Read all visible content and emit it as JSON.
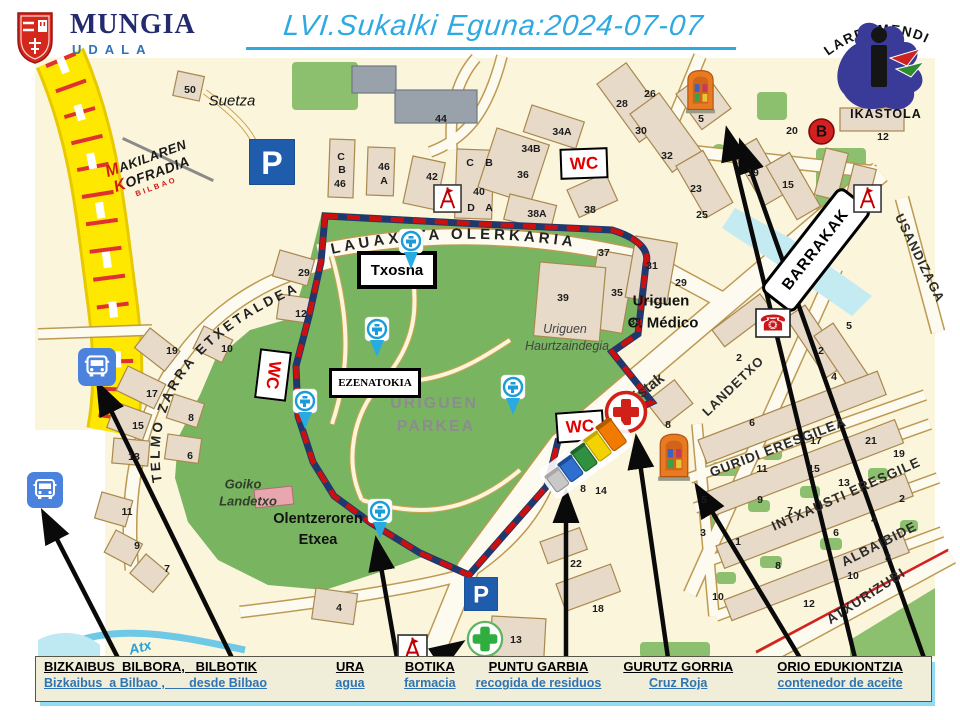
{
  "header": {
    "municipality": {
      "name": "MUNGIA",
      "subtitle": "UDALA"
    },
    "title": "LVI.Sukalki Eguna:2024-07-07",
    "school": {
      "top": "LARRAMENDI",
      "bottom": "IKASTOLA"
    },
    "brotherhood": {
      "line1": "MAKILAREN",
      "line2": "KOFRADIA",
      "line3": "BILBAO"
    }
  },
  "map": {
    "glyphs": {
      "parking": "P",
      "bus_line": "B",
      "phone": "☎",
      "wc": "WC"
    },
    "colors": {
      "title_blue": "#2FA9E2",
      "park_green": "#79B561",
      "dash_red": "#CC1010",
      "dash_navy": "#20386B",
      "legend_bg": "#F0EDD8",
      "accent_blue": "#2E74B5"
    },
    "arc_streets": [
      {
        "t": "LAUAXETA OLERKARIA"
      },
      {
        "t": "TELMO ZARRA ETXETALDEA"
      }
    ],
    "streets": [
      {
        "t": "Pistak",
        "x": 645,
        "y": 390,
        "r": -38,
        "s": 15,
        "b": 1
      },
      {
        "t": "LANDETXO",
        "x": 733,
        "y": 386,
        "r": -44,
        "s": 13,
        "ls": 1
      },
      {
        "t": "GURIDI ERESGILEA",
        "x": 778,
        "y": 447,
        "r": -21,
        "s": 13.5,
        "ls": 1
      },
      {
        "t": "INTXAUSTI ERESGILE",
        "x": 846,
        "y": 494,
        "r": -24,
        "s": 13.5,
        "ls": 1
      },
      {
        "t": "ALBAIBIDE",
        "x": 879,
        "y": 544,
        "r": -27,
        "s": 13.5,
        "ls": 1
      },
      {
        "t": "ATXURIZUBI",
        "x": 866,
        "y": 596,
        "r": -33,
        "s": 13.5,
        "ls": 1
      },
      {
        "t": "USANDIZAGA",
        "x": 920,
        "y": 258,
        "r": 64,
        "s": 13,
        "ls": 1
      }
    ],
    "places": [
      {
        "t": "Suetza",
        "x": 232,
        "y": 101,
        "s": 15,
        "i": 1,
        "c": "#111"
      },
      {
        "t": "Uriguen",
        "x": 661,
        "y": 301,
        "s": 15,
        "b": 1,
        "c": "#111"
      },
      {
        "t": "C. Médico",
        "x": 663,
        "y": 323,
        "s": 15,
        "b": 1,
        "c": "#111"
      },
      {
        "t": "Uriguen",
        "x": 565,
        "y": 329,
        "s": 12.5,
        "i": 1,
        "c": "#444"
      },
      {
        "t": "Haurtzaindegia",
        "x": 567,
        "y": 346,
        "s": 12.5,
        "i": 1,
        "c": "#444"
      },
      {
        "t": "URIGUEN",
        "x": 434,
        "y": 404,
        "s": 16,
        "b": 1,
        "c": "#8c8c8c",
        "ls": 2
      },
      {
        "t": "PARKEA",
        "x": 436,
        "y": 427,
        "s": 16,
        "b": 1,
        "c": "#8c8c8c",
        "ls": 2
      },
      {
        "t": "Goiko",
        "x": 243,
        "y": 484,
        "s": 13,
        "i": 1,
        "b": 1,
        "c": "#2f3f2a"
      },
      {
        "t": "Landetxo",
        "x": 248,
        "y": 501,
        "s": 13,
        "i": 1,
        "b": 1,
        "c": "#2f3f2a"
      },
      {
        "t": "Olentzeroren",
        "x": 318,
        "y": 519,
        "s": 14.5,
        "b": 1,
        "c": "#111"
      },
      {
        "t": "Etxea",
        "x": 318,
        "y": 540,
        "s": 14.5,
        "b": 1,
        "c": "#111"
      },
      {
        "t": "Atx",
        "x": 140,
        "y": 647,
        "s": 14,
        "i": 1,
        "b": 1,
        "c": "#2a9fd8",
        "r": -14
      }
    ],
    "boxes": [
      {
        "t": "Txosna",
        "x": 393,
        "y": 266,
        "w": 72,
        "h": 30,
        "bw": 4,
        "fs": 15,
        "c": "#000",
        "r": 0
      },
      {
        "t": "EZENATOKIA",
        "x": 372,
        "y": 380,
        "w": 86,
        "h": 24,
        "bw": 3,
        "fs": 11,
        "c": "#000",
        "r": 0,
        "serif": 1
      },
      {
        "t": "BARRAKAK",
        "x": 813,
        "y": 247,
        "w": 126,
        "h": 36,
        "bw": 3,
        "fs": 15.5,
        "c": "#000",
        "r": -52,
        "rad": 8,
        "ls": 1
      },
      {
        "t": "WC",
        "x": 582,
        "y": 161,
        "w": 44,
        "h": 27,
        "bw": 2.5,
        "fs": 17,
        "c": "#E00000",
        "r": -2
      },
      {
        "t": "WC",
        "x": 578,
        "y": 424,
        "w": 44,
        "h": 27,
        "bw": 2.5,
        "fs": 17,
        "c": "#E00000",
        "r": -4
      },
      {
        "t": "WC",
        "x": 271,
        "y": 373,
        "w": 46,
        "h": 28,
        "bw": 2.5,
        "fs": 17,
        "c": "#E00000",
        "r": 97
      }
    ],
    "icons": [
      {
        "n": "bus-stop-icon",
        "s": "bus",
        "x": 78,
        "y": 348,
        "w": 38,
        "h": 38
      },
      {
        "n": "bus-stop-icon",
        "s": "bus",
        "x": 27,
        "y": 472,
        "w": 36,
        "h": 36
      },
      {
        "n": "parking-icon",
        "s": "parking",
        "x": 249,
        "y": 139,
        "w": 46,
        "h": 46
      },
      {
        "n": "parking-icon",
        "s": "parking",
        "x": 464,
        "y": 577,
        "w": 34,
        "h": 34
      },
      {
        "n": "water-point-pin-icon",
        "s": "pin",
        "x": 396,
        "y": 228,
        "w": 30,
        "h": 42
      },
      {
        "n": "water-point-pin-icon",
        "s": "pin",
        "x": 362,
        "y": 316,
        "w": 30,
        "h": 42
      },
      {
        "n": "water-point-pin-icon",
        "s": "pin",
        "x": 290,
        "y": 388,
        "w": 30,
        "h": 42
      },
      {
        "n": "water-point-pin-icon",
        "s": "pin",
        "x": 498,
        "y": 374,
        "w": 30,
        "h": 42
      },
      {
        "n": "water-point-pin-icon",
        "s": "pin",
        "x": 365,
        "y": 498,
        "w": 30,
        "h": 42
      },
      {
        "n": "red-cross-icon",
        "s": "redcross",
        "x": 604,
        "y": 390,
        "w": 44,
        "h": 44
      },
      {
        "n": "pharmacy-cross-icon",
        "s": "greencross",
        "x": 466,
        "y": 620,
        "w": 38,
        "h": 38
      },
      {
        "n": "telephone-icon",
        "s": "phone",
        "x": 755,
        "y": 308,
        "w": 36,
        "h": 30
      },
      {
        "n": "monument-icon",
        "s": "monument",
        "x": 432,
        "y": 184,
        "w": 31,
        "h": 29
      },
      {
        "n": "monument-icon",
        "s": "monument",
        "x": 852,
        "y": 184,
        "w": 31,
        "h": 29
      },
      {
        "n": "monument-icon",
        "s": "monument",
        "x": 397,
        "y": 633,
        "w": 31,
        "h": 33
      },
      {
        "n": "bus-line-b-icon",
        "s": "bstop",
        "x": 808,
        "y": 118,
        "w": 27,
        "h": 27
      },
      {
        "n": "oil-container-icon",
        "s": "container",
        "x": 684,
        "y": 66,
        "w": 33,
        "h": 50
      },
      {
        "n": "oil-container-icon",
        "s": "container",
        "x": 656,
        "y": 430,
        "w": 36,
        "h": 53
      },
      {
        "n": "recycling-bins-icon",
        "s": "bins",
        "x": 540,
        "y": 418,
        "w": 92,
        "h": 80
      }
    ],
    "numbers": [
      [
        "50",
        190,
        90
      ],
      [
        "44",
        441,
        119
      ],
      [
        "34A",
        562,
        132
      ],
      [
        "34B",
        531,
        149
      ],
      [
        "36",
        523,
        175
      ],
      [
        "38A",
        537,
        214
      ],
      [
        "38",
        590,
        210
      ],
      [
        "42",
        432,
        177
      ],
      [
        "40",
        479,
        192
      ],
      [
        "C",
        341,
        157
      ],
      [
        "B",
        342,
        170
      ],
      [
        "46",
        340,
        184
      ],
      [
        "46",
        384,
        167
      ],
      [
        "A",
        384,
        181
      ],
      [
        "C",
        470,
        163
      ],
      [
        "B",
        489,
        163
      ],
      [
        "D",
        471,
        208
      ],
      [
        "A",
        489,
        208
      ],
      [
        "28",
        622,
        104
      ],
      [
        "26",
        650,
        94
      ],
      [
        "30",
        641,
        131
      ],
      [
        "32",
        667,
        156
      ],
      [
        "5",
        701,
        119
      ],
      [
        "12",
        883,
        137
      ],
      [
        "20",
        792,
        131
      ],
      [
        "19",
        753,
        173
      ],
      [
        "15",
        788,
        185
      ],
      [
        "23",
        696,
        189
      ],
      [
        "25",
        702,
        215
      ],
      [
        "31",
        652,
        266
      ],
      [
        "29",
        681,
        283
      ],
      [
        "35",
        617,
        293
      ],
      [
        "33",
        635,
        322
      ],
      [
        "39",
        563,
        298
      ],
      [
        "37",
        604,
        253
      ],
      [
        "2",
        739,
        358
      ],
      [
        "2",
        821,
        351
      ],
      [
        "4",
        834,
        377
      ],
      [
        "5",
        849,
        326
      ],
      [
        "8",
        668,
        425
      ],
      [
        "6",
        752,
        423
      ],
      [
        "8",
        583,
        489
      ],
      [
        "14",
        601,
        491
      ],
      [
        "17",
        816,
        441
      ],
      [
        "21",
        871,
        441
      ],
      [
        "19",
        899,
        454
      ],
      [
        "11",
        762,
        469
      ],
      [
        "15",
        814,
        469
      ],
      [
        "13",
        844,
        483
      ],
      [
        "9",
        760,
        500
      ],
      [
        "7",
        790,
        511
      ],
      [
        "5",
        704,
        500
      ],
      [
        "3",
        703,
        533
      ],
      [
        "1",
        738,
        542
      ],
      [
        "2",
        902,
        499
      ],
      [
        "4",
        874,
        520
      ],
      [
        "6",
        836,
        533
      ],
      [
        "8",
        888,
        558
      ],
      [
        "10",
        853,
        576
      ],
      [
        "8",
        778,
        566
      ],
      [
        "10",
        718,
        597
      ],
      [
        "12",
        809,
        604
      ],
      [
        "22",
        576,
        564
      ],
      [
        "18",
        598,
        609
      ],
      [
        "13",
        516,
        640
      ],
      [
        "4",
        339,
        608
      ],
      [
        "19",
        172,
        351
      ],
      [
        "10",
        227,
        349
      ],
      [
        "17",
        152,
        394
      ],
      [
        "15",
        138,
        426
      ],
      [
        "8",
        191,
        418
      ],
      [
        "6",
        190,
        456
      ],
      [
        "13",
        134,
        457
      ],
      [
        "11",
        127,
        512
      ],
      [
        "9",
        137,
        546
      ],
      [
        "7",
        167,
        569
      ],
      [
        "29",
        304,
        273
      ],
      [
        "12",
        301,
        314
      ]
    ]
  },
  "legend": {
    "items": [
      {
        "eu": "BIZKAIBUS  BILBORA,   BILBOTIK",
        "es": "Bizkaibus  a Bilbao ,       desde Bilbao"
      },
      {
        "eu": "URA",
        "es": "agua"
      },
      {
        "eu": "BOTIKA",
        "es": "farmacia"
      },
      {
        "eu": "PUNTU GARBIA",
        "es": "recogida de residuos"
      },
      {
        "eu": "GURUTZ GORRIA",
        "es": "Cruz Roja"
      },
      {
        "eu": "ORIO EDUKIONTZIA",
        "es": "contenedor de aceite"
      }
    ]
  }
}
